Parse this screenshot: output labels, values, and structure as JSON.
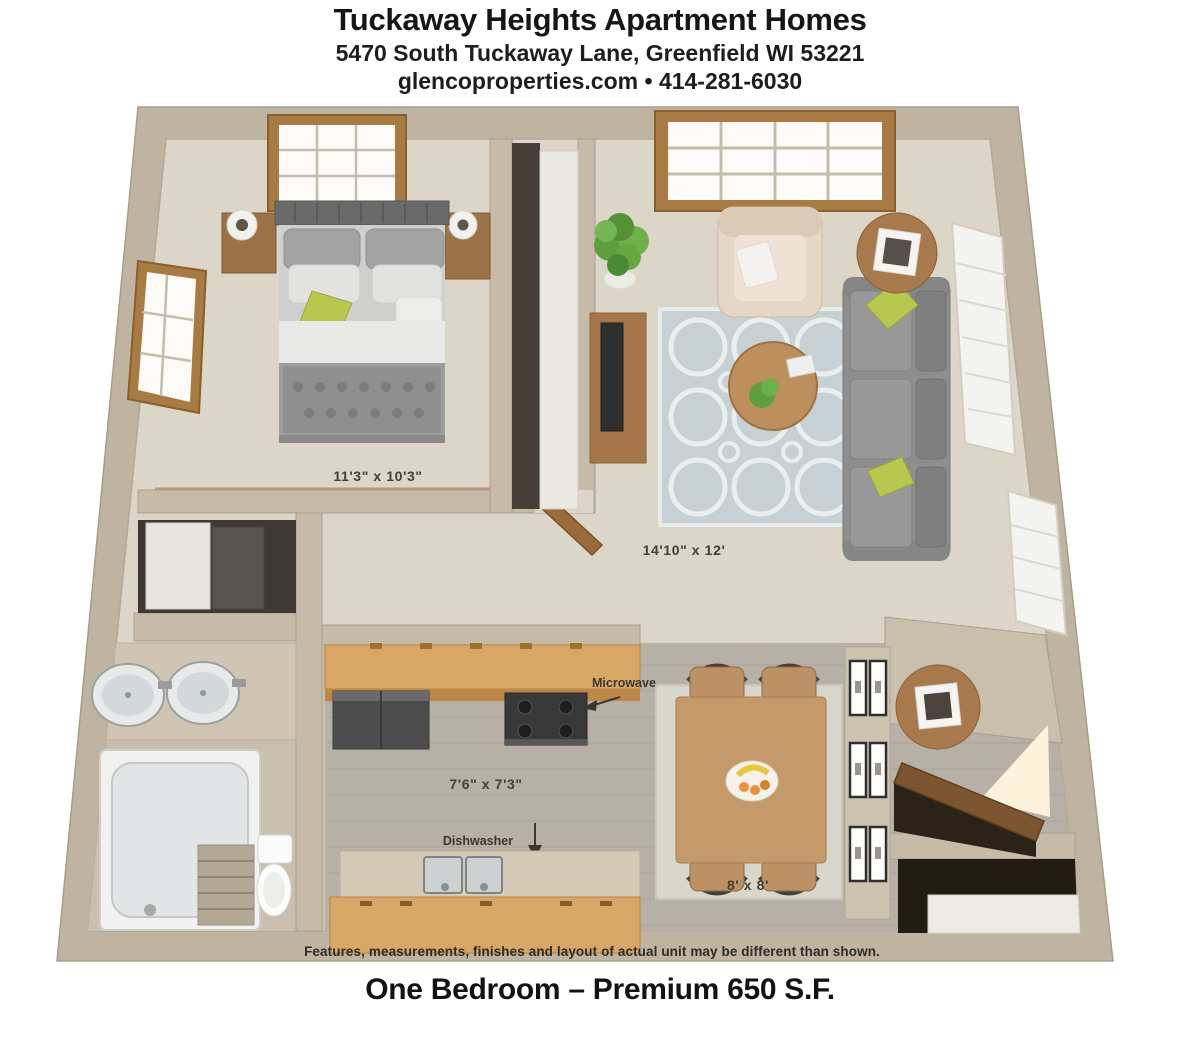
{
  "header": {
    "title": "Tuckaway Heights Apartment Homes",
    "address": "5470 South Tuckaway Lane, Greenfield WI 53221",
    "website": "glencoproperties.com",
    "separator": "•",
    "phone": "414-281-6030"
  },
  "floor_plan": {
    "rooms": {
      "bedroom": {
        "dimensions": "11'3\" x 10'3\""
      },
      "living_room": {
        "dimensions": "14'10\" x 12'"
      },
      "kitchen": {
        "dimensions": "7'6\" x 7'3\""
      },
      "dining_area": {
        "dimensions": "8' x 8'"
      }
    },
    "appliance_labels": {
      "microwave": "Microwave",
      "dishwasher": "Dishwasher"
    },
    "disclaimer": "Features, measurements, finishes and layout of actual unit may be different than shown."
  },
  "footer": {
    "plan_name": "One Bedroom – Premium 650 S.F."
  },
  "palette": {
    "wall": "#c4b9a6",
    "carpet": "#dcd6c9",
    "wood_floor": "#b6b0a6",
    "cabinet_wood": "#d8a768",
    "furniture_wood": "#ad7c4e",
    "sofa_gray": "#8e8e8e",
    "accent_green": "#b8c84e",
    "rug_blue": "#c7d1d3"
  }
}
